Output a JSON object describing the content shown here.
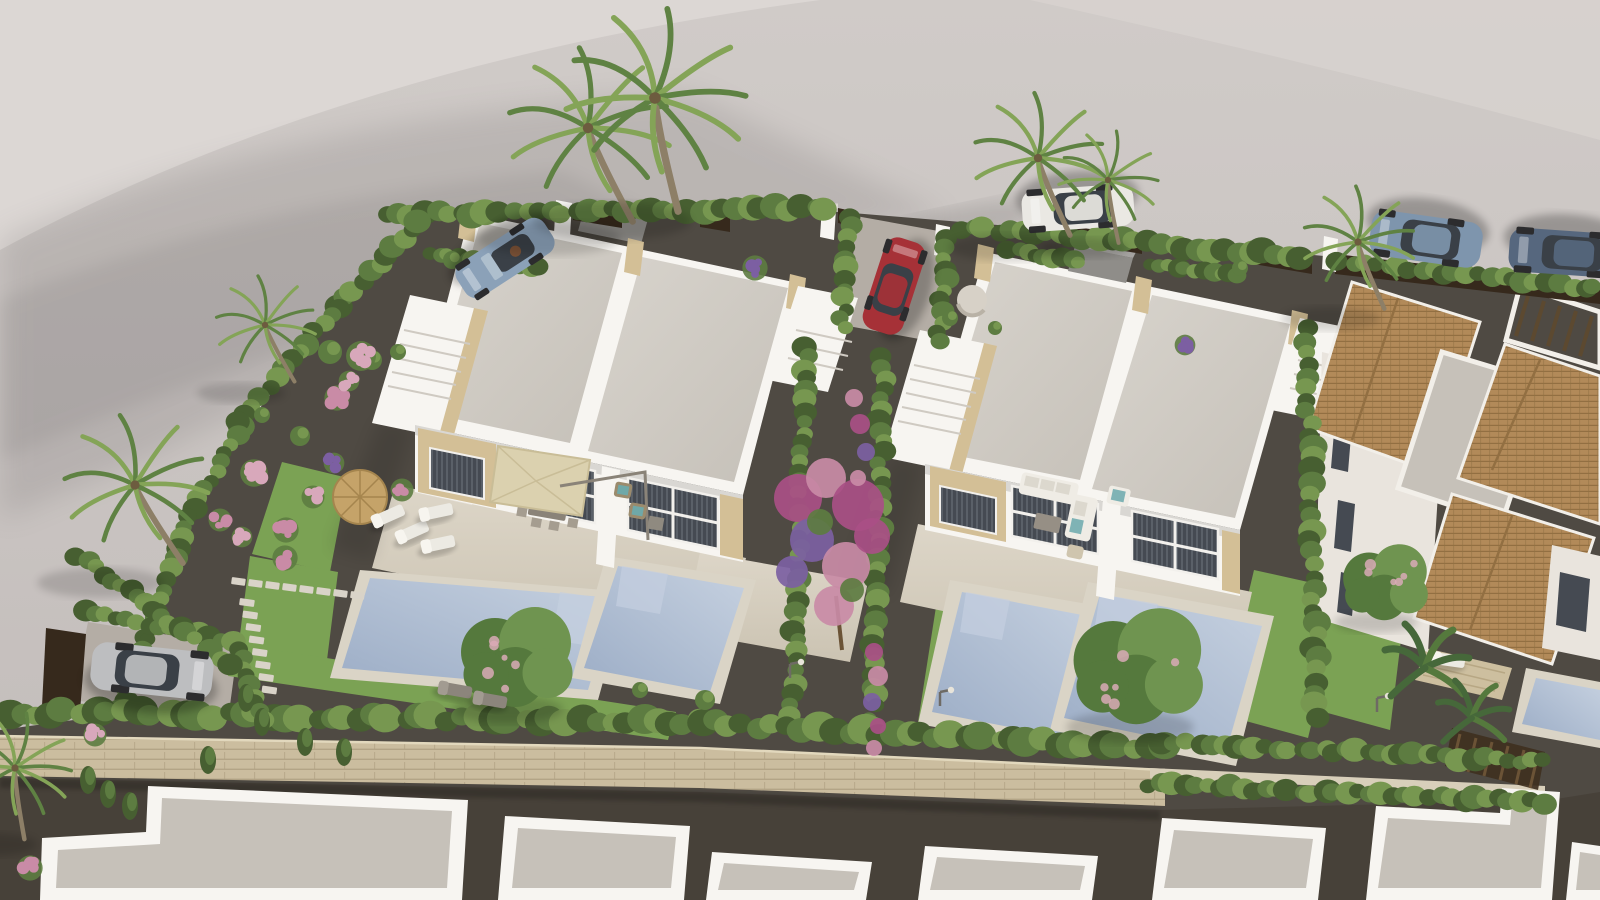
{
  "scene": {
    "kind": "aerial-3d-architectural-render",
    "subject": "residential development of white modern duplex villas with private pools, gardens, palm trees and parked cars"
  },
  "palette": {
    "bgRoad": "#cac4c2",
    "bgLight": "#dcd7d4",
    "devGravel": "#4f4a43",
    "roadDark": "#474139",
    "wallStone": "#cbbd9f",
    "wallStoneDark": "#b3a486",
    "pathStone": "#d8cfba",
    "grass": "#7ba254",
    "grassDark": "#65883f",
    "hedge": "#5d7c41",
    "hedgeLight": "#779750",
    "hedgeDark": "#475f31",
    "villaWhite": "#f7f5f1",
    "villaShade": "#e9e4dd",
    "villaDark": "#d9d3ca",
    "roofGravel": "#d3cec7",
    "roofShade": "#c6c1b9",
    "sandstone": "#d3bf96",
    "sandstoneDark": "#b7a179",
    "window": "#454a52",
    "windowLight": "#79808a",
    "terrace": "#d7d0c1",
    "terraceShade": "#c8c0af",
    "pool": "#a7b6cc",
    "poolLight": "#c4cfdf",
    "poolDark": "#91a3bd",
    "coping": "#dad4c6",
    "terracotta": "#b28a59",
    "terracottaDark": "#926f42",
    "wood": "#5c4930",
    "fenceDark": "#36291c",
    "umbrella": "#dbd1af",
    "straw": "#c5a369",
    "strawDark": "#a5854e",
    "carBlue": "#8ba1b8",
    "carSteel": "#7e95ad",
    "carRed": "#a63137",
    "carSilver": "#bdbec0",
    "carWhite": "#eae8e3",
    "carNavy": "#56677e",
    "glassCol": "#3a4047",
    "furnWhite": "#efece5",
    "furnGray": "#968f85",
    "flowerPink": "#d8a8bb",
    "flowerRose": "#c98ba6",
    "magenta": "#a94f86",
    "purple": "#7c5fa2",
    "trunk": "#8d7f67",
    "palmGreen": "#5f8243",
    "palmLight": "#84a457",
    "bananaGreen": "#46683a",
    "treeGreen": "#55793d",
    "treeLight": "#6f9450",
    "blossom": "#d9aab6"
  },
  "hedgerows": [
    {
      "x1": 388,
      "y1": 214,
      "x2": 826,
      "y2": 208,
      "r": 12
    },
    {
      "x1": 960,
      "y1": 228,
      "x2": 1300,
      "y2": 256,
      "r": 12
    },
    {
      "x1": 1340,
      "y1": 262,
      "x2": 1595,
      "y2": 288,
      "r": 11
    },
    {
      "x1": 337,
      "y1": 306,
      "x2": 420,
      "y2": 222,
      "r": 11
    },
    {
      "x1": 337,
      "y1": 306,
      "x2": 240,
      "y2": 424,
      "r": 11
    },
    {
      "x1": 240,
      "y1": 424,
      "x2": 190,
      "y2": 518,
      "r": 10
    },
    {
      "x1": 190,
      "y1": 518,
      "x2": 146,
      "y2": 640,
      "r": 10
    },
    {
      "x1": 146,
      "y1": 640,
      "x2": 120,
      "y2": 710,
      "r": 10
    },
    {
      "x1": 852,
      "y1": 216,
      "x2": 842,
      "y2": 330,
      "r": 10
    },
    {
      "x1": 948,
      "y1": 238,
      "x2": 938,
      "y2": 342,
      "r": 10
    },
    {
      "x1": 806,
      "y1": 348,
      "x2": 792,
      "y2": 714,
      "r": 10
    },
    {
      "x1": 884,
      "y1": 358,
      "x2": 872,
      "y2": 728,
      "r": 10
    },
    {
      "x1": 1306,
      "y1": 330,
      "x2": 1318,
      "y2": 716,
      "r": 11
    },
    {
      "x1": 6,
      "y1": 712,
      "x2": 700,
      "y2": 722,
      "r": 14
    },
    {
      "x1": 700,
      "y1": 722,
      "x2": 1162,
      "y2": 748,
      "r": 14
    },
    {
      "x1": 1165,
      "y1": 742,
      "x2": 1540,
      "y2": 762,
      "r": 11
    },
    {
      "x1": 1150,
      "y1": 784,
      "x2": 1545,
      "y2": 802,
      "r": 11
    },
    {
      "x1": 84,
      "y1": 612,
      "x2": 232,
      "y2": 640,
      "r": 10
    },
    {
      "x1": 240,
      "y1": 650,
      "x2": 262,
      "y2": 722,
      "r": 9
    },
    {
      "x1": 78,
      "y1": 556,
      "x2": 230,
      "y2": 664,
      "r": 10
    },
    {
      "x1": 430,
      "y1": 252,
      "x2": 540,
      "y2": 268,
      "r": 9
    },
    {
      "x1": 1010,
      "y1": 250,
      "x2": 1080,
      "y2": 262,
      "r": 9
    },
    {
      "x1": 1150,
      "y1": 264,
      "x2": 1240,
      "y2": 276,
      "r": 9
    }
  ],
  "cypresses": [
    [
      88,
      780
    ],
    [
      108,
      794
    ],
    [
      130,
      806
    ],
    [
      208,
      760
    ],
    [
      246,
      698
    ],
    [
      262,
      722
    ],
    [
      305,
      742
    ],
    [
      344,
      752
    ]
  ],
  "flowers": [
    [
      361,
      356,
      13,
      "pink"
    ],
    [
      337,
      398,
      11,
      "rose"
    ],
    [
      254,
      473,
      12,
      "pink"
    ],
    [
      220,
      520,
      10,
      "rose"
    ],
    [
      242,
      537,
      9,
      "pink"
    ],
    [
      286,
      530,
      11,
      "rose"
    ],
    [
      313,
      497,
      10,
      "pink"
    ],
    [
      285,
      558,
      11,
      "rose"
    ],
    [
      334,
      463,
      9,
      "purple"
    ],
    [
      402,
      490,
      10,
      "rose"
    ],
    [
      349,
      381,
      9,
      "pink"
    ],
    [
      505,
      264,
      9,
      "purple"
    ],
    [
      755,
      268,
      11,
      "purple"
    ],
    [
      1185,
      345,
      9,
      "purple"
    ],
    [
      30,
      868,
      11,
      "rose"
    ],
    [
      95,
      735,
      10,
      "pink"
    ]
  ],
  "bushes": [
    [
      330,
      352,
      12
    ],
    [
      372,
      360,
      10
    ],
    [
      398,
      352,
      8
    ],
    [
      300,
      436,
      10
    ],
    [
      262,
      415,
      8
    ],
    [
      950,
      318,
      8
    ],
    [
      995,
      328,
      7
    ],
    [
      1240,
      268,
      8
    ],
    [
      452,
      260,
      9
    ],
    [
      478,
      272,
      8
    ],
    [
      705,
      700,
      10
    ],
    [
      640,
      690,
      8
    ]
  ],
  "trees": [
    {
      "x": 520,
      "y": 662,
      "r": 50,
      "blossom": true
    },
    {
      "x": 1142,
      "y": 672,
      "r": 58,
      "blossom": true
    },
    {
      "x": 1388,
      "y": 586,
      "r": 38,
      "blossom": true
    }
  ],
  "palms": [
    {
      "x": 588,
      "y": 128,
      "s": 1.3,
      "r": -8
    },
    {
      "x": 655,
      "y": 98,
      "s": 1.45,
      "r": 6
    },
    {
      "x": 1038,
      "y": 158,
      "s": 1.05,
      "r": -5
    },
    {
      "x": 1108,
      "y": 180,
      "s": 0.8,
      "r": 8
    },
    {
      "x": 1358,
      "y": 242,
      "s": 0.9,
      "r": -4
    },
    {
      "x": 265,
      "y": 325,
      "s": 0.8,
      "r": -10
    },
    {
      "x": 135,
      "y": 485,
      "s": 1.15,
      "r": -14
    },
    {
      "x": 15,
      "y": 768,
      "s": 0.9,
      "r": 10
    }
  ],
  "bananas": [
    {
      "x": 1425,
      "y": 668,
      "s": 1.0
    },
    {
      "x": 1472,
      "y": 718,
      "s": 0.85
    }
  ],
  "bougainvillea": [
    [
      798,
      498,
      24,
      0
    ],
    [
      826,
      478,
      20,
      1
    ],
    [
      858,
      505,
      26,
      0
    ],
    [
      812,
      540,
      22,
      2
    ],
    [
      846,
      566,
      24,
      1
    ],
    [
      872,
      536,
      18,
      0
    ],
    [
      792,
      572,
      16,
      2
    ],
    [
      834,
      606,
      20,
      1
    ],
    [
      820,
      522,
      13,
      3
    ],
    [
      852,
      590,
      12,
      3
    ],
    [
      854,
      398,
      9,
      1
    ],
    [
      860,
      424,
      10,
      0
    ],
    [
      866,
      452,
      9,
      2
    ],
    [
      858,
      478,
      8,
      1
    ],
    [
      874,
      652,
      9,
      0
    ],
    [
      878,
      676,
      10,
      1
    ],
    [
      872,
      702,
      9,
      2
    ],
    [
      878,
      726,
      8,
      0
    ],
    [
      874,
      748,
      8,
      1
    ]
  ],
  "stepping_stones": [
    {
      "x": 232,
      "y": 577,
      "dx": 17,
      "dy": 2,
      "n": 8,
      "w": 14,
      "h": 7,
      "rot": 8
    },
    {
      "x": 240,
      "y": 598,
      "dx": 3.2,
      "dy": 12.5,
      "n": 8,
      "w": 15,
      "h": 7,
      "rot": 8
    }
  ],
  "cars": [
    {
      "name": "blue-convertible",
      "x": 505,
      "y": 258,
      "rot": 147,
      "len": 104,
      "wid": 40,
      "body": "carBlue",
      "convertible": true
    },
    {
      "name": "white-hatchback",
      "x": 1078,
      "y": 208,
      "rot": 176,
      "len": 112,
      "wid": 42,
      "body": "carWhite"
    },
    {
      "name": "blue-suv",
      "x": 1426,
      "y": 239,
      "rot": 188,
      "len": 112,
      "wid": 46,
      "body": "carSteel"
    },
    {
      "name": "navy-sedan",
      "x": 1568,
      "y": 253,
      "rot": 184,
      "len": 118,
      "wid": 44,
      "body": "carNavy"
    },
    {
      "name": "red-hatchback",
      "x": 894,
      "y": 286,
      "rot": -72,
      "len": 96,
      "wid": 42,
      "body": "carRed"
    },
    {
      "name": "silver-suv",
      "x": 152,
      "y": 671,
      "rot": 6,
      "len": 122,
      "wid": 48,
      "body": "carSilver"
    }
  ],
  "lamps": [
    [
      790,
      678
    ],
    [
      940,
      706
    ],
    [
      1377,
      712
    ]
  ],
  "loungers": [
    {
      "x": 388,
      "y": 516,
      "rot": -24,
      "style": "light"
    },
    {
      "x": 412,
      "y": 532,
      "rot": -24,
      "style": "light"
    },
    {
      "x": 436,
      "y": 512,
      "rot": -12,
      "style": "light"
    },
    {
      "x": 438,
      "y": 544,
      "rot": -12,
      "style": "light"
    },
    {
      "x": 455,
      "y": 690,
      "rot": 10,
      "style": "dark"
    },
    {
      "x": 490,
      "y": 700,
      "rot": 10,
      "style": "dark"
    },
    {
      "x": 1448,
      "y": 660,
      "rot": 8,
      "style": "light"
    }
  ]
}
